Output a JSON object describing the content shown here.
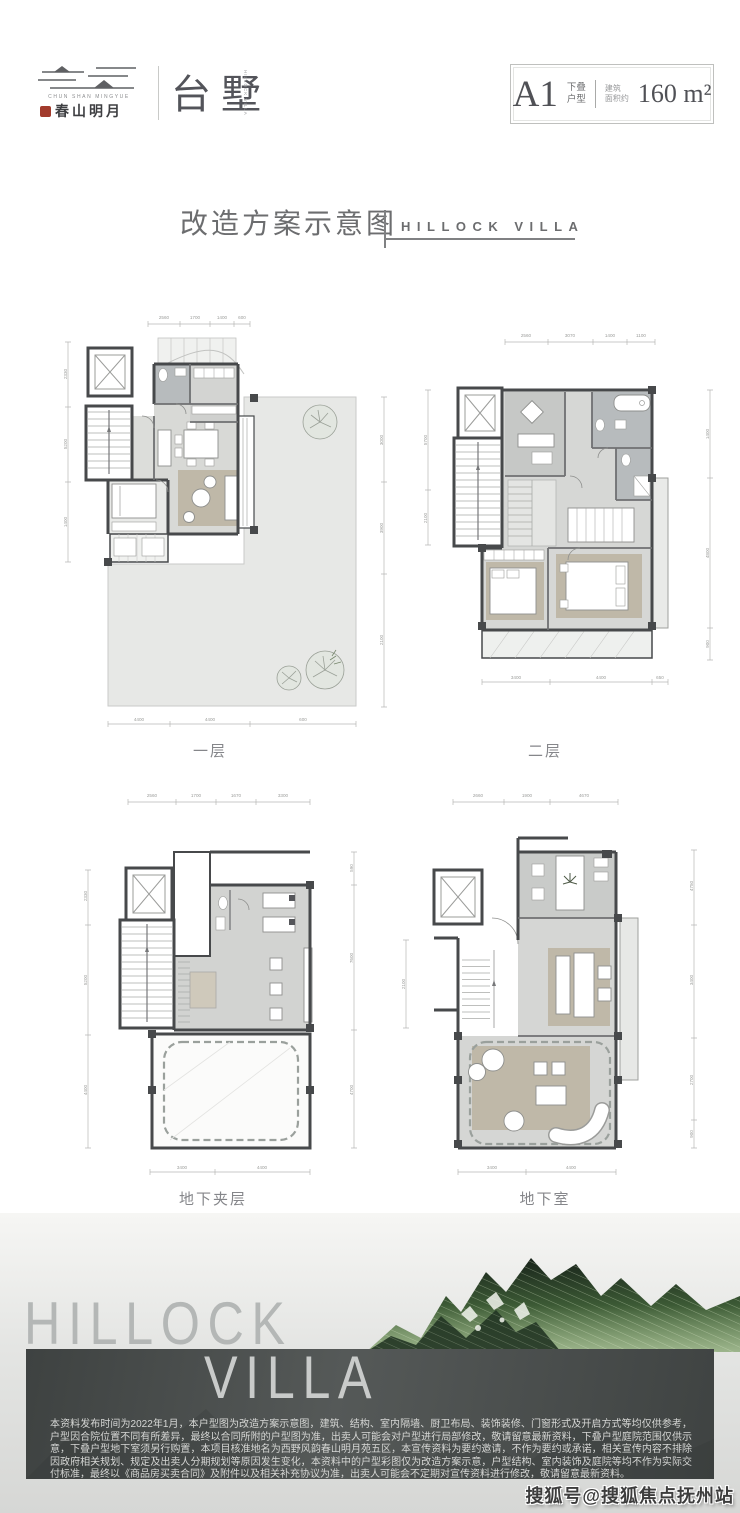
{
  "header": {
    "logo_en": "CHUN SHAN MINGYUE",
    "logo_cn": "春山明月",
    "brand": "台墅",
    "brand_sub": "HILLOCK VILLA",
    "badge": {
      "code": "A1",
      "type_top": "下叠",
      "type_bottom": "户型",
      "area_top": "建筑",
      "area_bottom": "面积约",
      "area_value": "160 m²"
    }
  },
  "title": {
    "cn": "改造方案示意图",
    "en": "HILLOCK VILLA"
  },
  "plans": [
    {
      "label": "一层",
      "dims_top": [
        "2560",
        "1700",
        "1400",
        "600"
      ],
      "dims_bottom": [
        "4400",
        "4400",
        "600"
      ],
      "dims_left": [
        "2330",
        "5200",
        "1400"
      ],
      "dims_right": [
        "3000",
        "3900",
        "2100"
      ]
    },
    {
      "label": "二层",
      "dims_top": [
        "2560",
        "3070",
        "1400",
        "1100"
      ],
      "dims_bottom": [
        "3400",
        "4400",
        "650"
      ],
      "dims_left": [
        "5700",
        "2100"
      ],
      "dims_right": [
        "1400",
        "4800",
        "900"
      ]
    },
    {
      "label": "地下夹层",
      "dims_top": [
        "2560",
        "1700",
        "1670",
        "3300"
      ],
      "dims_bottom": [
        "3400",
        "4400"
      ],
      "dims_left": [
        "2330",
        "5200",
        "4400"
      ],
      "dims_right": [
        "590",
        "7600",
        "4700"
      ]
    },
    {
      "label": "地下室",
      "dims_top": [
        "2660",
        "1900",
        "4670"
      ],
      "dims_bottom": [
        "3400",
        "4400"
      ],
      "dims_left": [
        "2100"
      ],
      "dims_right": [
        "4750",
        "3400",
        "2700",
        "900"
      ]
    }
  ],
  "footer": {
    "big1": "HILLOCK",
    "big2": "VILLA",
    "disclaimer": "本资料发布时间为2022年1月，本户型图为改造方案示意图，建筑、结构、室内隔墙、厨卫布局、装饰装修、门窗形式及开启方式等均仅供参考，户型因合院位置不同有所差异，最终以合同所附的户型图为准，出卖人可能会对户型进行局部修改，敬请留意最新资料，下叠户型庭院范围仅供示意，下叠户型地下室须另行购置，本项目核准地名为西野风韵春山明月苑五区，本宣传资料为要约邀请，不作为要约或承诺，相关宣传内容不排除因政府相关规划、规定及出卖人分期规划等原因发生变化，本资料中的户型彩图仅为改造方案示意，户型结构、室内装饰及庭院等均不作为实际交付标准，最终以《商品房买卖合同》及附件以及相关补充协议为准，出卖人可能会不定期对宣传资料进行修改，敬请留意最新资料。",
    "watermark": "搜狐号@搜狐焦点抚州站"
  },
  "colors": {
    "seal_red": "#a23b2c",
    "wall": "#47494b",
    "floor_gray": "#d7d8d5",
    "wet_gray": "#b7bbbd",
    "rug_tan": "#bfb8a8",
    "band_dark": "#474b4a",
    "mountain_green": "#3c5a35"
  }
}
